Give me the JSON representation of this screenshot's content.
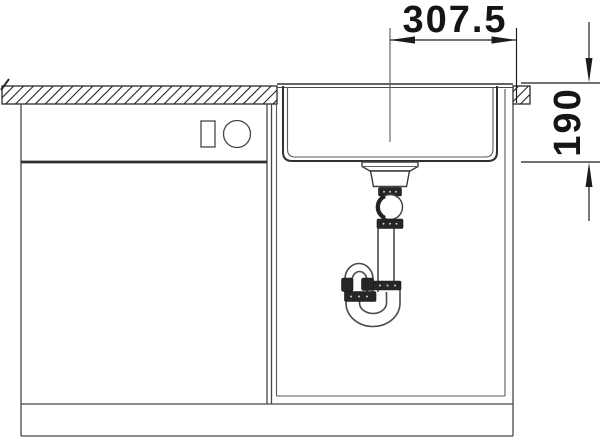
{
  "drawing": {
    "type": "sink-installation-front-view",
    "dimensions": {
      "horizontal": {
        "value": "307.5"
      },
      "vertical": {
        "value": "190"
      }
    },
    "colors": {
      "background": "#ffffff",
      "line": "#474747",
      "strong_line": "#303030",
      "dimension": "#1c1c1c",
      "dark_fitting": "#262626"
    },
    "parts": {
      "countertop": "worktop-cross-section-hatched",
      "left_cabinet": "base-cabinet-with-control-panel",
      "sink_cabinet": "sink-base-cabinet",
      "sink_bowl": "undermount-bowl",
      "drain": "strainer-ball-joint-tailpipe",
      "trap": "tubular-siphon-with-union-nuts",
      "plinth": "cabinet-plinth"
    }
  }
}
